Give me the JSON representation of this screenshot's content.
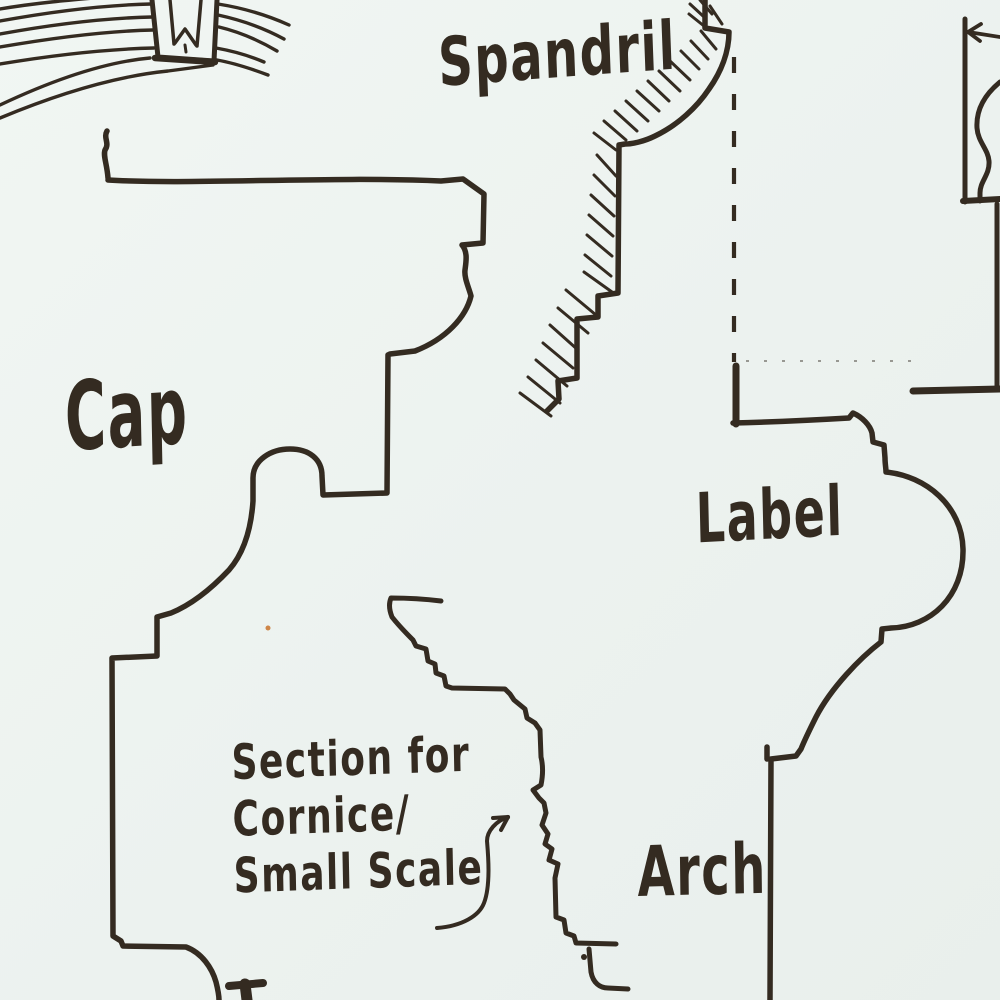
{
  "colors": {
    "ink": "#342b21",
    "paper": "#edf3f0",
    "speck": "#c8722a"
  },
  "labels": {
    "spandril": "Spandril",
    "cap": "Cap",
    "label_molding": "Label",
    "arch": "Arch",
    "section_note": {
      "line1": "Section for",
      "line2": "Cornice/",
      "line3": "Small Scale"
    }
  }
}
